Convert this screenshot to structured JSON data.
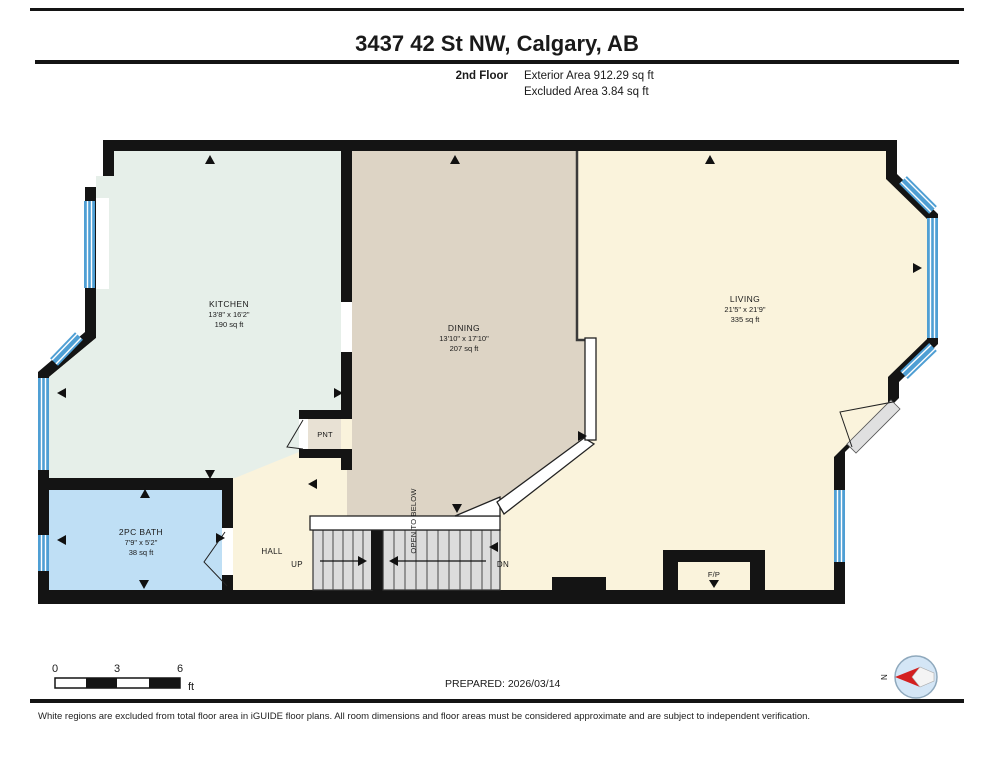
{
  "header": {
    "title": "3437 42 St NW, Calgary, AB",
    "floor_label": "2nd Floor",
    "exterior_area": "Exterior Area 912.29 sq ft",
    "excluded_area": "Excluded Area 3.84 sq ft"
  },
  "rooms": {
    "kitchen": {
      "name": "KITCHEN",
      "dims": "13'8\" x 16'2\"",
      "area": "190 sq ft"
    },
    "dining": {
      "name": "DINING",
      "dims": "13'10\" x 17'10\"",
      "area": "207 sq ft"
    },
    "living": {
      "name": "LIVING",
      "dims": "21'5\" x 21'9\"",
      "area": "335 sq ft"
    },
    "bath": {
      "name": "2PC BATH",
      "dims": "7'9\" x 5'2\"",
      "area": "38 sq ft"
    },
    "pantry": {
      "name": "PNT"
    },
    "hall": {
      "name": "HALL"
    }
  },
  "stairs": {
    "up_label": "UP",
    "down_label": "DN",
    "open_below_label": "OPEN TO BELOW"
  },
  "fireplace_label": "F/P",
  "footer": {
    "prepared": "PREPARED: 2026/03/14",
    "disclaimer": "White regions are excluded from total floor area in iGUIDE floor plans. All room dimensions and floor areas must be considered approximate and are subject to independent verification.",
    "scale_bar": {
      "tick0": "0",
      "tick1": "3",
      "tick2": "6",
      "unit": "ft"
    },
    "compass_label": "N"
  },
  "colors": {
    "wall": "#141414",
    "kitchen_floor": "#e6efe9",
    "dining_floor": "#ddd4c5",
    "living_floor": "#faf3dc",
    "bath_floor": "#bfdff5",
    "pantry_floor": "#e8e1d4",
    "stairs": "#dcdcdc",
    "window": "#4f9fd4",
    "compass_needle": "#d42020"
  }
}
